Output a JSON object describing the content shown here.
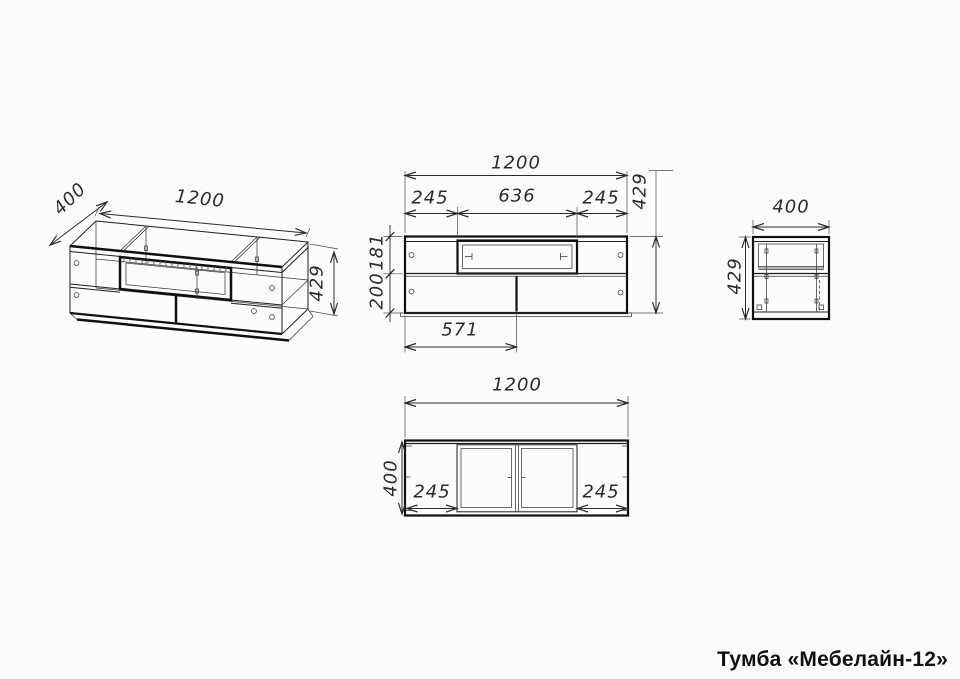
{
  "title": "Тумба «Мебелайн-12»",
  "views": {
    "isometric": {
      "dims": {
        "width": "1200",
        "depth": "400",
        "height": "429"
      }
    },
    "front": {
      "dims": {
        "width": "1200",
        "niche_left": "245",
        "niche_width": "636",
        "niche_right": "245",
        "height": "429",
        "upper_section": "181",
        "lower_section": "200",
        "left_door_width": "571"
      }
    },
    "side": {
      "dims": {
        "depth": "400",
        "height": "429"
      }
    },
    "top": {
      "dims": {
        "width": "1200",
        "depth": "400",
        "left_panel": "245",
        "right_panel": "245"
      }
    }
  }
}
